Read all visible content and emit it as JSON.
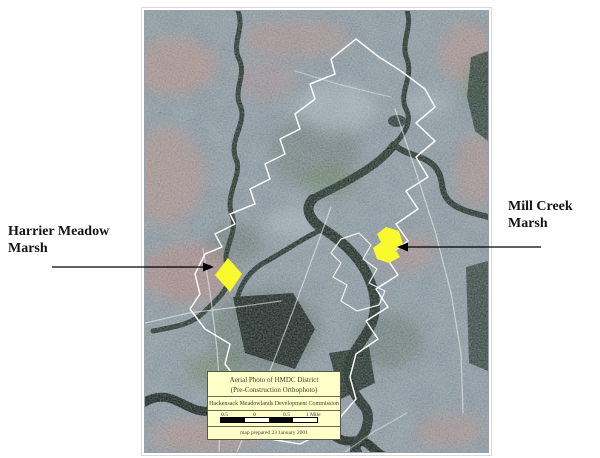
{
  "page": {
    "background_color": "#ffffff"
  },
  "map_figure": {
    "district_outline_color": "#ffffff",
    "highlight_color": "#ffff00",
    "photo_base_color": "#828f9a",
    "water_color": "#1c2a23"
  },
  "annotations": {
    "harrier": {
      "line1": "Harrier Meadow",
      "line2": "Marsh"
    },
    "millcreek": {
      "line1": "Mill Creek",
      "line2": "Marsh"
    }
  },
  "legend": {
    "title_line1": "Aerial Photo of HMDC District",
    "title_line2": "(Pre-Construction Orthophoto)",
    "commission": "Hackensack Meadowlands Development Commission",
    "scale_labels": [
      "0.5",
      "0",
      "0.5",
      "1 Mile"
    ],
    "prepared_note": "map prepared 23 January 2001",
    "background_color": "#ffffc8",
    "border_color": "#55554a"
  }
}
